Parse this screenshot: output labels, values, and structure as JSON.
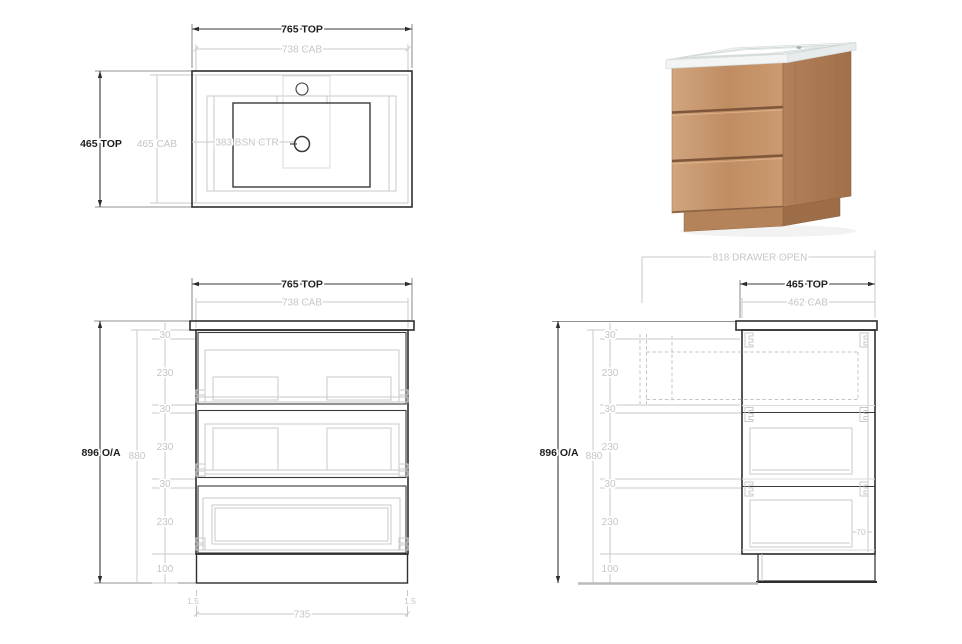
{
  "plan": {
    "width_top": "765 TOP",
    "width_cab": "738 CAB",
    "depth_top": "465 TOP",
    "depth_cab": "465 CAB",
    "basin_ctr": "383 BSN CTR"
  },
  "front": {
    "width_top": "765 TOP",
    "width_cab": "738 CAB",
    "overall": "896 O/A",
    "cab_height": "880",
    "kick_width": "735",
    "kick_inset_left": "1.5",
    "kick_inset_right": "1.5"
  },
  "side": {
    "drawer_open": "818 DRAWER OPEN",
    "depth_top": "465 TOP",
    "depth_cab": "462 CAB",
    "overall": "896 O/A",
    "cab_height": "880",
    "drawer_back_gap": "70"
  },
  "chain": [
    "30",
    "230",
    "30",
    "230",
    "30",
    "230",
    "100"
  ],
  "colors": {
    "line_dark": "#2e2e2e",
    "line_gray": "#c7cacc",
    "text_dark": "#1e1e1e",
    "text_gray": "#c3c6c8",
    "wood_light": "#cda07a",
    "wood_mid": "#c08d63",
    "wood_side": "#ab7850",
    "wood_shadow": "#8a6143",
    "benchtop_white": "#f6f8f8"
  }
}
